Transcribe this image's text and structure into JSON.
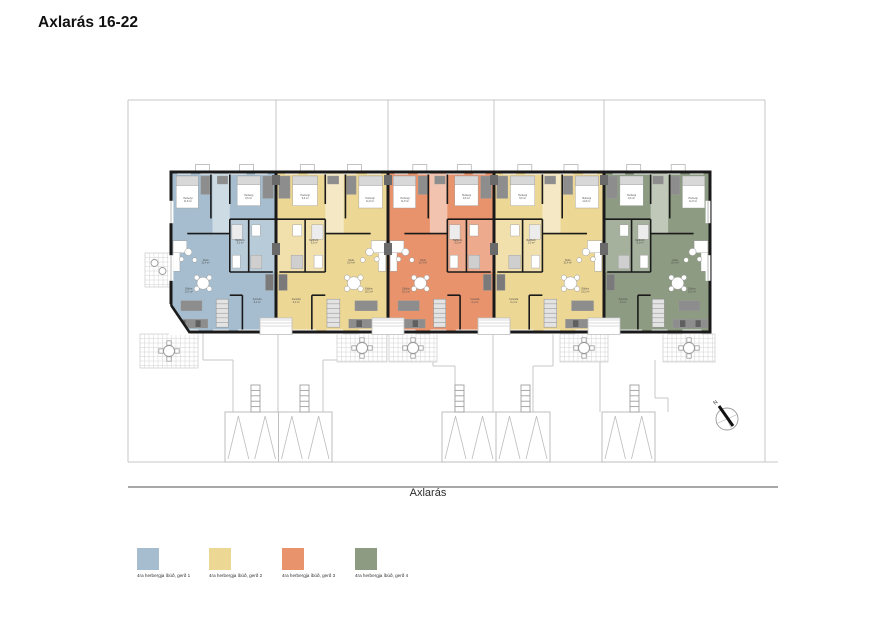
{
  "title": "Axlarás 16-22",
  "street_label": "Axlarás",
  "north_arrow": {
    "cx": 727,
    "cy": 419,
    "r": 11,
    "label": "N"
  },
  "colors": {
    "wall": "#1a1a1a",
    "site_line": "#c7c7c7",
    "street_line": "#a8a8a8",
    "furniture_dark": "#8d8d8d",
    "furniture_mid": "#cfcfcf",
    "white": "#ffffff"
  },
  "legend": {
    "items": [
      {
        "label": "4ra herbergja íbúð, gerð 1",
        "color": "#a5bdce",
        "x": 137,
        "y": 548
      },
      {
        "label": "4ra herbergja íbúð, gerð 2",
        "color": "#edd795",
        "x": 209,
        "y": 548
      },
      {
        "label": "4ra herbergja íbúð, gerð 3",
        "color": "#e8936c",
        "x": 282,
        "y": 548
      },
      {
        "label": "4ra herbergja íbúð, gerð 4",
        "color": "#8c9b81",
        "x": 355,
        "y": 548
      }
    ]
  },
  "building": {
    "top": 172,
    "bottom": 332,
    "units": [
      {
        "name": "unit-1",
        "type": "gerð 1",
        "color": "#a5bdce",
        "x": 171,
        "w": 105,
        "mirrored": false
      },
      {
        "name": "unit-2",
        "type": "gerð 2",
        "color": "#edd795",
        "x": 276,
        "w": 112,
        "mirrored": true
      },
      {
        "name": "unit-3",
        "type": "gerð 3",
        "color": "#e8936c",
        "x": 388,
        "w": 106,
        "mirrored": false
      },
      {
        "name": "unit-4",
        "type": "gerð 2",
        "color": "#edd795",
        "x": 494,
        "w": 110,
        "mirrored": true
      },
      {
        "name": "unit-5",
        "type": "gerð 4",
        "color": "#8c9b81",
        "x": 604,
        "w": 106,
        "mirrored": true
      }
    ],
    "party_walls": [
      276,
      388,
      494,
      604
    ]
  },
  "room_labels": [
    {
      "name": "Herbergi",
      "area": "11,8 m²",
      "x": 0.16,
      "y": 0.17
    },
    {
      "name": "Herbergi",
      "area": "9,6 m²",
      "x": 0.74,
      "y": 0.15
    },
    {
      "name": "Baðherb.",
      "area": "5,2 m²",
      "x": 0.66,
      "y": 0.43
    },
    {
      "name": "Stofa",
      "area": "31,4 m²",
      "x": 0.33,
      "y": 0.555
    },
    {
      "name": "Eldhús",
      "area": "10,2 m²",
      "x": 0.17,
      "y": 0.735
    },
    {
      "name": "Forstofa",
      "area": "6,1 m²",
      "x": 0.82,
      "y": 0.8
    }
  ],
  "site_lines": [
    [
      128,
      100,
      765,
      100
    ],
    [
      128,
      100,
      128,
      462
    ],
    [
      765,
      100,
      765,
      462
    ],
    [
      276,
      100,
      276,
      171
    ],
    [
      388,
      100,
      388,
      171
    ],
    [
      494,
      100,
      494,
      171
    ],
    [
      604,
      100,
      604,
      171
    ],
    [
      128,
      462,
      778,
      462
    ],
    [
      203,
      333,
      203,
      360
    ],
    [
      203,
      360,
      233,
      360
    ],
    [
      233,
      360,
      233,
      412
    ],
    [
      278,
      333,
      278,
      412
    ],
    [
      323,
      360,
      323,
      412
    ],
    [
      323,
      360,
      347,
      360
    ],
    [
      347,
      333,
      347,
      360
    ],
    [
      433,
      333,
      433,
      366
    ],
    [
      433,
      366,
      455,
      366
    ],
    [
      455,
      366,
      455,
      412
    ],
    [
      493,
      333,
      493,
      412
    ],
    [
      533,
      366,
      533,
      412
    ],
    [
      533,
      366,
      553,
      366
    ],
    [
      553,
      333,
      553,
      366
    ],
    [
      588,
      333,
      588,
      360
    ],
    [
      588,
      360,
      600,
      360
    ],
    [
      600,
      360,
      600,
      412
    ],
    [
      655,
      360,
      655,
      398
    ],
    [
      655,
      398,
      668,
      398
    ],
    [
      668,
      398,
      668,
      412
    ]
  ],
  "street_line": [
    128,
    487,
    778,
    487
  ],
  "sheds": [
    {
      "x": 225,
      "y": 412,
      "w": 107,
      "h": 50,
      "tris": 4,
      "divider": true
    },
    {
      "x": 442,
      "y": 412,
      "w": 108,
      "h": 50,
      "tris": 4,
      "divider": true
    },
    {
      "x": 602,
      "y": 412,
      "w": 53,
      "h": 50,
      "tris": 2,
      "divider": false
    }
  ],
  "ladders": [
    {
      "x": 251,
      "y": 385
    },
    {
      "x": 300,
      "y": 385
    },
    {
      "x": 455,
      "y": 385
    },
    {
      "x": 521,
      "y": 385
    },
    {
      "x": 630,
      "y": 385
    }
  ],
  "terraces": [
    {
      "x": 145,
      "y": 253,
      "w": 27,
      "h": 34,
      "type": "chairs"
    },
    {
      "x": 140,
      "y": 334,
      "w": 58,
      "h": 34,
      "type": "table"
    },
    {
      "x": 337,
      "y": 334,
      "w": 50,
      "h": 28,
      "type": "table"
    },
    {
      "x": 389,
      "y": 334,
      "w": 48,
      "h": 28,
      "type": "table"
    },
    {
      "x": 560,
      "y": 334,
      "w": 48,
      "h": 28,
      "type": "table"
    },
    {
      "x": 663,
      "y": 334,
      "w": 52,
      "h": 28,
      "type": "table"
    }
  ]
}
